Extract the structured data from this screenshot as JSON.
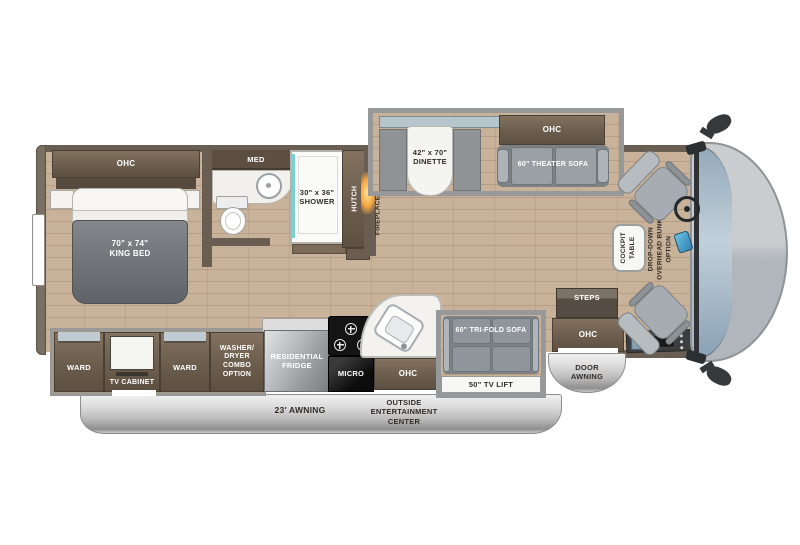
{
  "bedroom": {
    "ohc": "OHC",
    "bed_size": "70\" x 74\"",
    "bed_name": "KING BED"
  },
  "bath": {
    "med": "MED",
    "shower_size": "30\" x 36\"",
    "shower_name": "SHOWER"
  },
  "hall": {
    "hutch": "HUTCH",
    "fireplace": "FIREPLACE"
  },
  "dinette": {
    "size": "42\" x 70\"",
    "name": "DINETTE"
  },
  "theater": {
    "ohc": "OHC",
    "sofa": "60\" THEATER SOFA"
  },
  "cockpit": {
    "table_l1": "COCKPIT",
    "table_l2": "TABLE",
    "bunk_l1": "DROP-DOWN",
    "bunk_l2": "OVERHEAD BUNK",
    "bunk_l3": "OPTION"
  },
  "entry": {
    "steps": "STEPS",
    "ohc": "OHC",
    "awning_l1": "DOOR",
    "awning_l2": "AWNING"
  },
  "living": {
    "sofa": "60\" TRI-FOLD SOFA",
    "tv_lift": "50\" TV LIFT"
  },
  "wardrobe": {
    "ward_left": "WARD",
    "tv_cabinet": "TV CABINET",
    "ward_right": "WARD",
    "wd_l1": "WASHER/",
    "wd_l2": "DRYER",
    "wd_l3": "COMBO",
    "wd_l4": "OPTION"
  },
  "kitchen": {
    "fridge_l1": "RESIDENTIAL",
    "fridge_l2": "FRIDGE",
    "micro": "MICRO",
    "ohc": "OHC"
  },
  "exterior": {
    "awning": "23' AWNING",
    "oec_l1": "OUTSIDE",
    "oec_l2": "ENTERTAINMENT",
    "oec_l3": "CENTER"
  },
  "colors": {
    "floor": "#c8b29a",
    "cabinet": "#6f6050",
    "shower_accent": "#7ad0d1",
    "fireplace_glow": "#f5a944",
    "windshield": "#a9bfce",
    "awning_silver": "#dcdcdc"
  }
}
